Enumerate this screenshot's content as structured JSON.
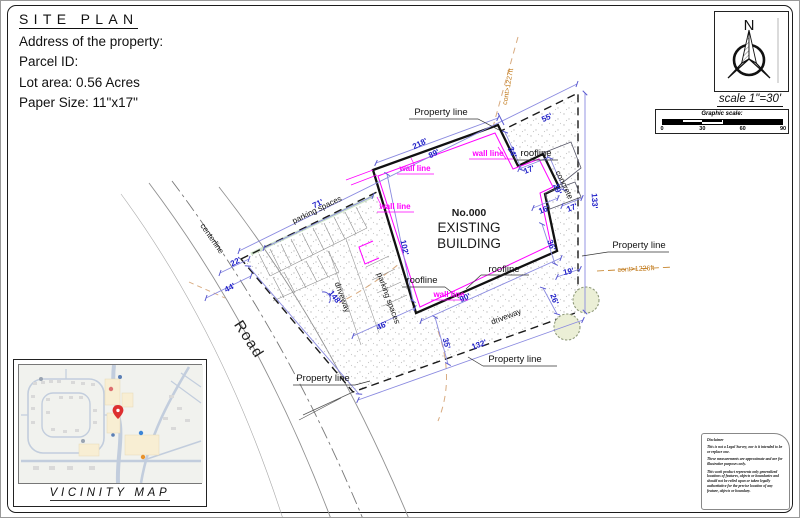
{
  "title_block": {
    "title": "SITE PLAN",
    "address": "Address of the property:",
    "parcel": "Parcel ID:",
    "lot_area": "Lot area: 0.56 Acres",
    "paper_size": "Paper Size: 11\"x17\""
  },
  "north": {
    "letter": "N",
    "scale": "scale 1\"=30'"
  },
  "graphic_scale": {
    "title": "Graphic scale:",
    "ticks": [
      "0",
      "30",
      "60",
      "90"
    ]
  },
  "vicinity": {
    "label": "VICINITY MAP"
  },
  "disclaimer": {
    "title": "Disclaimer",
    "paragraphs": [
      "This is not a Legal Survey, nor is it intended to be or replace one.",
      "These measurements are approximate and are for illustrative purposes only.",
      "This work product represents only generalized locations of features, objects or boundaries and should not be relied upon or taken legally authoritative for the precise location of any feature, objects or boundary."
    ]
  },
  "colors": {
    "dimension_text": "#2020c8",
    "dimension_line": "#8a8ae0",
    "wall_line": "#ff00dd",
    "contour": "#c07818",
    "boundary": "#1a1a1a"
  },
  "plan": {
    "labels": [
      {
        "text": "Property line",
        "x": 440,
        "y": 114,
        "rot": 0,
        "cls": "pl lbl-md",
        "name": "label-property-line-top"
      },
      {
        "text": "Property line",
        "x": 638,
        "y": 247,
        "rot": 0,
        "cls": "pl lbl-md",
        "name": "label-property-line-right"
      },
      {
        "text": "Property line",
        "x": 514,
        "y": 361,
        "rot": 0,
        "cls": "pl lbl-md",
        "name": "label-property-line-bottom-right"
      },
      {
        "text": "Property line",
        "x": 322,
        "y": 380,
        "rot": 0,
        "cls": "pl lbl-md",
        "name": "label-property-line-bottom-left"
      },
      {
        "text": "roofline",
        "x": 535,
        "y": 155,
        "rot": 0,
        "cls": "pl lbl-md",
        "name": "label-roofline-top"
      },
      {
        "text": "roofline",
        "x": 421,
        "y": 282,
        "rot": 0,
        "cls": "pl lbl-md",
        "name": "label-roofline-left"
      },
      {
        "text": "roofline",
        "x": 503,
        "y": 271,
        "rot": 0,
        "cls": "pl lbl-md",
        "name": "label-roofline-center"
      },
      {
        "text": "centerline",
        "x": 209,
        "y": 239,
        "rot": 55,
        "cls": "pl",
        "name": "label-centerline"
      },
      {
        "text": "Road",
        "x": 244,
        "y": 341,
        "rot": 57,
        "cls": "pl lbl-road",
        "name": "label-road"
      },
      {
        "text": "driveway",
        "x": 339,
        "y": 297,
        "rot": 70,
        "cls": "pl",
        "name": "label-driveway-left"
      },
      {
        "text": "driveway",
        "x": 506,
        "y": 318,
        "rot": -21,
        "cls": "pl",
        "name": "label-driveway-right"
      },
      {
        "text": "parking spaces",
        "x": 317,
        "y": 211,
        "rot": -26,
        "cls": "pl",
        "name": "label-parking-spaces-top"
      },
      {
        "text": "parking spaces",
        "x": 385,
        "y": 298,
        "rot": 70,
        "cls": "pl",
        "name": "label-parking-spaces-side"
      },
      {
        "text": "concrete",
        "x": 561,
        "y": 185,
        "rot": 64,
        "cls": "pl",
        "name": "label-concrete"
      },
      {
        "text": "No.000",
        "x": 468,
        "y": 215,
        "rot": 0,
        "cls": "pl lbl-bldno",
        "name": "label-building-number"
      },
      {
        "text": "EXISTING",
        "x": 468,
        "y": 231,
        "rot": 0,
        "cls": "pl lbl-bld",
        "name": "label-building-line1"
      },
      {
        "text": "BUILDING",
        "x": 468,
        "y": 247,
        "rot": 0,
        "cls": "pl lbl-bld",
        "name": "label-building-line2"
      },
      {
        "text": "wall line",
        "x": 487,
        "y": 155,
        "rot": 0,
        "cls": "mag",
        "name": "label-wall-line-1"
      },
      {
        "text": "wall line",
        "x": 414,
        "y": 170,
        "rot": 0,
        "cls": "mag",
        "name": "label-wall-line-2"
      },
      {
        "text": "wall line",
        "x": 394,
        "y": 208,
        "rot": 0,
        "cls": "mag",
        "name": "label-wall-line-3"
      },
      {
        "text": "wall line",
        "x": 448,
        "y": 296,
        "rot": 0,
        "cls": "mag",
        "name": "label-wall-line-4"
      },
      {
        "text": "cont>1227ft",
        "x": 509,
        "y": 86,
        "rot": -80,
        "cls": "org",
        "name": "label-contour-1227"
      },
      {
        "text": "cont>1226ft",
        "x": 635,
        "y": 270,
        "rot": -3,
        "cls": "org",
        "name": "label-contour-1226"
      }
    ],
    "dimensions": [
      {
        "text": "218'",
        "x": 420,
        "y": 145,
        "rot": -26
      },
      {
        "text": "89'",
        "x": 434,
        "y": 155,
        "rot": -26
      },
      {
        "text": "55'",
        "x": 547,
        "y": 119,
        "rot": -25
      },
      {
        "text": "71'",
        "x": 318,
        "y": 205,
        "rot": -26
      },
      {
        "text": "22'",
        "x": 236,
        "y": 263,
        "rot": -27
      },
      {
        "text": "44'",
        "x": 230,
        "y": 289,
        "rot": -27
      },
      {
        "text": "148'",
        "x": 332,
        "y": 298,
        "rot": 52
      },
      {
        "text": "102'",
        "x": 401,
        "y": 247,
        "rot": 78
      },
      {
        "text": "46'",
        "x": 382,
        "y": 327,
        "rot": -24
      },
      {
        "text": "35'",
        "x": 443,
        "y": 343,
        "rot": 75
      },
      {
        "text": "90'",
        "x": 465,
        "y": 299,
        "rot": -24
      },
      {
        "text": "132'",
        "x": 479,
        "y": 346,
        "rot": -20
      },
      {
        "text": "133'",
        "x": 591,
        "y": 200,
        "rot": 87
      },
      {
        "text": "34'",
        "x": 509,
        "y": 152,
        "rot": 68
      },
      {
        "text": "17'",
        "x": 529,
        "y": 171,
        "rot": -22
      },
      {
        "text": "29'",
        "x": 554,
        "y": 189,
        "rot": 68
      },
      {
        "text": "16'",
        "x": 544,
        "y": 211,
        "rot": -22
      },
      {
        "text": "17'",
        "x": 572,
        "y": 209,
        "rot": -22
      },
      {
        "text": "36'",
        "x": 548,
        "y": 245,
        "rot": 70
      },
      {
        "text": "19'",
        "x": 568,
        "y": 273,
        "rot": -12
      },
      {
        "text": "26'",
        "x": 551,
        "y": 299,
        "rot": 70
      }
    ]
  }
}
